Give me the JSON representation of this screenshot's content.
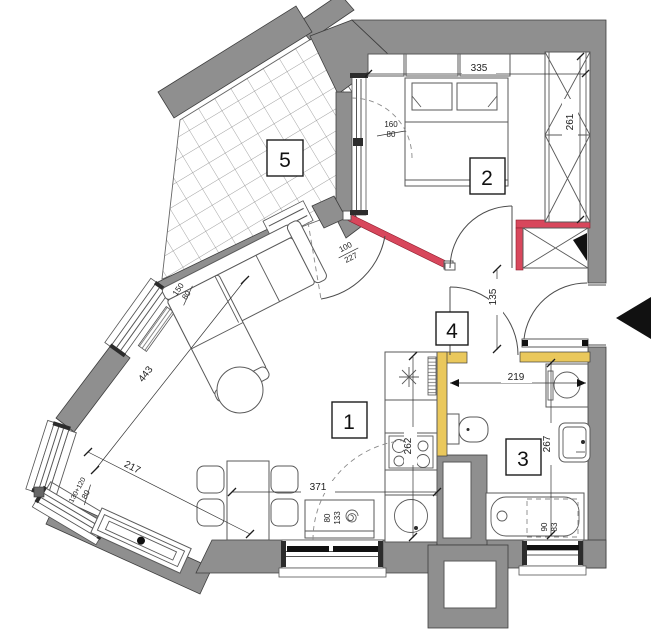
{
  "title": "Apartment floor plan",
  "rooms": {
    "living": "1",
    "bedroom": "2",
    "bathroom": "3",
    "hall": "4",
    "balcony": "5"
  },
  "dims": {
    "d_bed_width": "335",
    "d_wardrobe": "261",
    "d_bedwin_w": "160",
    "d_bedwin_h": "80",
    "d_redwall_w": "100",
    "d_redwall_h": "227",
    "d_hall": "135",
    "d_diag": "443",
    "d_livwin_w": "150",
    "d_livwin_h": "80",
    "d_cornerwin_w": "130+120",
    "d_cornerwin_h": "80",
    "d_tvwall": "217",
    "d_livwidth": "371",
    "d_botwin_w": "80",
    "d_botwin_h": "133",
    "d_kitchen": "262",
    "d_bath_w": "219",
    "d_bath_h": "267",
    "d_bathwin_w": "90",
    "d_bathwin_h": "83"
  },
  "colors": {
    "wall_gray": "#8f8f8f",
    "wall_red": "#d8475c",
    "wall_yellow": "#eac85c",
    "line": "#3e3e3e"
  }
}
